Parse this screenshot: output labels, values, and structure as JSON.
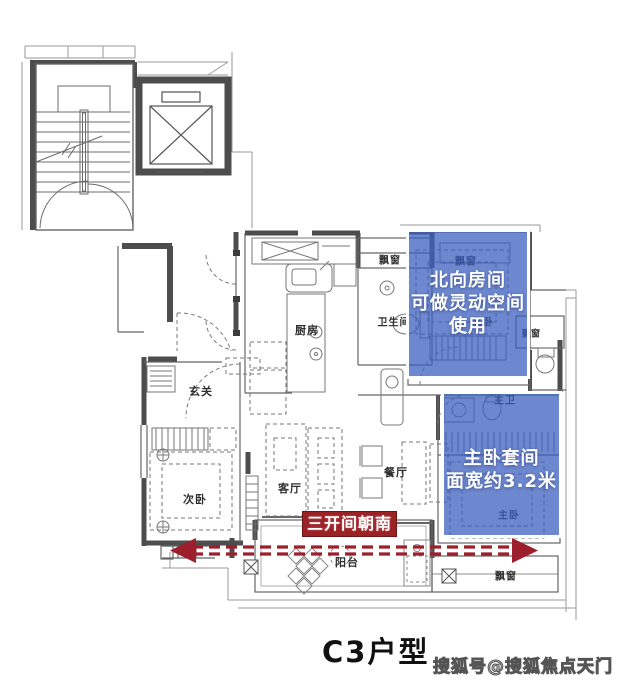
{
  "title": "C3户型",
  "watermark": "搜狐号@搜狐焦点天门站",
  "rooms": {
    "entry": "玄关",
    "kitchen": "厨房",
    "bathroom": "卫生间",
    "second_bedroom": "次卧",
    "living_room": "客厅",
    "dining_room": "餐厅",
    "balcony": "阳台",
    "north_bedroom": "北卧",
    "master_bedroom": "主卧",
    "master_bathroom": "主卫",
    "bay_window": "飘窗"
  },
  "annotations": {
    "north_room_note": {
      "line1": "北向房间",
      "line2": "可做灵动空间",
      "line3": "使用"
    },
    "master_suite_note": {
      "line1": "主卧套间",
      "line2": "面宽约3.2米"
    },
    "south_banner": "三开间朝南"
  },
  "colors": {
    "overlay_blue": "#3a5ebe",
    "banner_red": "#9b2125",
    "arrow_red": "#9e1f2c",
    "wall_dark": "#4d4d4d"
  }
}
